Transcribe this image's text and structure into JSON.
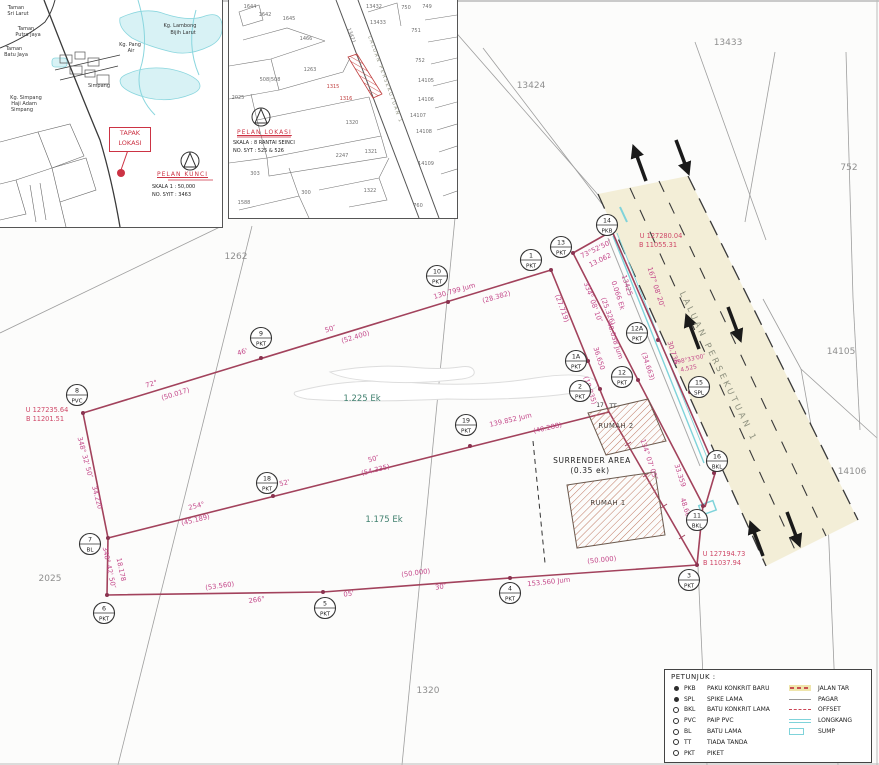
{
  "inset_key_map": {
    "title": "PELAN KUNCI",
    "scale": "SKALA 1 : 50,000",
    "sheet": "NO. SYIT : 3463",
    "marker_label": [
      "TAPAK",
      "LOKASI"
    ],
    "labels": [
      {
        "t": "Taman",
        "x": 16,
        "y": 9
      },
      {
        "t": "Sri Larut",
        "x": 18,
        "y": 15
      },
      {
        "t": "Taman",
        "x": 26,
        "y": 30
      },
      {
        "t": "Putra Jaya",
        "x": 28,
        "y": 36
      },
      {
        "t": "Taman",
        "x": 14,
        "y": 50
      },
      {
        "t": "Batu Jaya",
        "x": 16,
        "y": 56
      },
      {
        "t": "Kg. Lambong",
        "x": 180,
        "y": 27
      },
      {
        "t": "Bijih Larut",
        "x": 183,
        "y": 34
      },
      {
        "t": "Kg. Pang",
        "x": 130,
        "y": 46
      },
      {
        "t": "Air",
        "x": 131,
        "y": 52
      },
      {
        "t": "Simpang",
        "x": 99,
        "y": 87
      },
      {
        "t": "Kg. Simpang",
        "x": 26,
        "y": 99
      },
      {
        "t": "Haji Adam",
        "x": 24,
        "y": 105
      },
      {
        "t": "Simpang",
        "x": 22,
        "y": 111
      }
    ]
  },
  "inset_location_plan": {
    "title": "PELAN LOKASI",
    "scale": "SKALA : 8 RANTAI SEINCI",
    "sheet": "NO. SYT : 525 & 526",
    "road_label": "LALUAN PERSEKUTUAN 1",
    "labels": [
      {
        "t": "1644",
        "x": 21,
        "y": 8
      },
      {
        "t": "1642",
        "x": 36,
        "y": 16
      },
      {
        "t": "1645",
        "x": 60,
        "y": 20
      },
      {
        "t": "1466",
        "x": 77,
        "y": 40
      },
      {
        "t": "13432",
        "x": 145,
        "y": 8
      },
      {
        "t": "13433",
        "x": 149,
        "y": 24
      },
      {
        "t": "750",
        "x": 177,
        "y": 9
      },
      {
        "t": "749",
        "x": 198,
        "y": 8
      },
      {
        "t": "751",
        "x": 187,
        "y": 32
      },
      {
        "t": "1263",
        "x": 81,
        "y": 71
      },
      {
        "t": "508|508",
        "x": 41,
        "y": 81
      },
      {
        "t": "752",
        "x": 191,
        "y": 62
      },
      {
        "t": "2025",
        "x": 9,
        "y": 99
      },
      {
        "t": "1315",
        "x": 104,
        "y": 88,
        "c": "redl"
      },
      {
        "t": "1316",
        "x": 117,
        "y": 100,
        "c": "redl"
      },
      {
        "t": "14105",
        "x": 197,
        "y": 82
      },
      {
        "t": "14106",
        "x": 197,
        "y": 101
      },
      {
        "t": "14107",
        "x": 189,
        "y": 117
      },
      {
        "t": "14108",
        "x": 195,
        "y": 133
      },
      {
        "t": "1320",
        "x": 123,
        "y": 124
      },
      {
        "t": "1321",
        "x": 142,
        "y": 153
      },
      {
        "t": "2247",
        "x": 113,
        "y": 157
      },
      {
        "t": "14109",
        "x": 197,
        "y": 165
      },
      {
        "t": "303",
        "x": 26,
        "y": 175
      },
      {
        "t": "300",
        "x": 77,
        "y": 194
      },
      {
        "t": "1322",
        "x": 141,
        "y": 192
      },
      {
        "t": "1588",
        "x": 15,
        "y": 204
      },
      {
        "t": "760",
        "x": 189,
        "y": 207
      },
      {
        "t": "13421",
        "x": 121,
        "y": 36,
        "r": 70
      },
      {
        "t": "LALUAN PERSEKUTUAN 1",
        "x": 155,
        "y": 80,
        "r": 70,
        "c": "i2road"
      }
    ]
  },
  "main_plan": {
    "road_label": "LALUAN PERSEKUTUAN 1",
    "labels": [
      {
        "t": "72°",
        "x": 152,
        "y": 386,
        "r": -17
      },
      {
        "t": "(50.017)",
        "x": 176,
        "y": 396,
        "r": -17
      },
      {
        "t": "46'",
        "x": 243,
        "y": 354,
        "r": -17
      },
      {
        "t": "50″",
        "x": 331,
        "y": 331,
        "r": -17
      },
      {
        "t": "(52.400)",
        "x": 356,
        "y": 339,
        "r": -17
      },
      {
        "t": "130.799 Jum",
        "x": 455,
        "y": 293,
        "r": -16
      },
      {
        "t": "(28.382)",
        "x": 497,
        "y": 299,
        "r": -16
      },
      {
        "t": "254°",
        "x": 197,
        "y": 508,
        "r": -14
      },
      {
        "t": "(45.189)",
        "x": 196,
        "y": 522,
        "r": -14
      },
      {
        "t": "52'",
        "x": 285,
        "y": 485,
        "r": -14
      },
      {
        "t": "50″",
        "x": 374,
        "y": 461,
        "r": -14
      },
      {
        "t": "(54.335)",
        "x": 376,
        "y": 472,
        "r": -14
      },
      {
        "t": "139.852 Jum",
        "x": 511,
        "y": 422,
        "r": -13
      },
      {
        "t": "(40.288)",
        "x": 548,
        "y": 430,
        "r": -13
      },
      {
        "t": "(53.560)",
        "x": 220,
        "y": 588,
        "r": -8
      },
      {
        "t": "266°",
        "x": 257,
        "y": 602,
        "r": -8
      },
      {
        "t": "05'",
        "x": 349,
        "y": 596,
        "r": -8
      },
      {
        "t": "(50.000)",
        "x": 416,
        "y": 575,
        "r": -8
      },
      {
        "t": "30″",
        "x": 441,
        "y": 589,
        "r": -8
      },
      {
        "t": "153.560 Jum",
        "x": 549,
        "y": 584,
        "r": -6
      },
      {
        "t": "(50.000)",
        "x": 602,
        "y": 562,
        "r": -6
      },
      {
        "t": "348° 32' 50″",
        "x": 83,
        "y": 458,
        "r": 75
      },
      {
        "t": "34.220",
        "x": 95,
        "y": 498,
        "r": 75
      },
      {
        "t": "348° 42' 50″",
        "x": 107,
        "y": 568,
        "r": 78
      },
      {
        "t": "18.178",
        "x": 119,
        "y": 570,
        "r": 78
      },
      {
        "t": "73°52'50″",
        "x": 597,
        "y": 251,
        "r": -26
      },
      {
        "t": "13.062",
        "x": 601,
        "y": 262,
        "r": -26
      },
      {
        "t": "(27.719)",
        "x": 560,
        "y": 309,
        "r": 70
      },
      {
        "t": "334° 08' 10″",
        "x": 591,
        "y": 303,
        "r": 70
      },
      {
        "t": "(25.326)",
        "x": 606,
        "y": 312,
        "r": 70
      },
      {
        "t": "13425",
        "x": 625,
        "y": 286,
        "r": 72
      },
      {
        "t": "0.066 Ek",
        "x": 616,
        "y": 296,
        "r": 72
      },
      {
        "t": "40.038 Jum",
        "x": 613,
        "y": 341,
        "r": 72
      },
      {
        "t": "36.650",
        "x": 597,
        "y": 359,
        "r": 72
      },
      {
        "t": "(18.835)",
        "x": 588,
        "y": 391,
        "r": 72
      },
      {
        "t": "167° 08' 20″",
        "x": 654,
        "y": 288,
        "r": 72
      },
      {
        "t": "30.736",
        "x": 671,
        "y": 353,
        "r": 72
      },
      {
        "t": "(34.663)",
        "x": 646,
        "y": 367,
        "r": 72
      },
      {
        "t": "298°33'00″",
        "x": 690,
        "y": 361,
        "r": -12,
        "c": "m6"
      },
      {
        "t": "4.525",
        "x": 689,
        "y": 370,
        "r": -12,
        "c": "m6"
      },
      {
        "t": "134° 07' 05″",
        "x": 647,
        "y": 460,
        "r": 72
      },
      {
        "t": "33.359",
        "x": 678,
        "y": 476,
        "r": 72
      },
      {
        "t": "48.664",
        "x": 684,
        "y": 510,
        "r": 72
      },
      {
        "t": "U 127235.64",
        "x": 47,
        "y": 412,
        "c": "r"
      },
      {
        "t": "B 11201.51",
        "x": 45,
        "y": 421,
        "c": "r"
      },
      {
        "t": "U 127280.04",
        "x": 661,
        "y": 238,
        "c": "r"
      },
      {
        "t": "B 11055.31",
        "x": 658,
        "y": 247,
        "c": "r"
      },
      {
        "t": "U 127194.73",
        "x": 724,
        "y": 556,
        "c": "r"
      },
      {
        "t": "B 11037.94",
        "x": 722,
        "y": 565,
        "c": "r"
      },
      {
        "t": "1.225 Ek",
        "x": 362,
        "y": 401,
        "c": "t"
      },
      {
        "t": "1.175 Ek",
        "x": 384,
        "y": 522,
        "c": "t"
      },
      {
        "t": "13424",
        "x": 531,
        "y": 88,
        "c": "g"
      },
      {
        "t": "13433",
        "x": 728,
        "y": 45,
        "c": "g"
      },
      {
        "t": "752",
        "x": 849,
        "y": 170,
        "c": "g"
      },
      {
        "t": "14105",
        "x": 841,
        "y": 354,
        "c": "g"
      },
      {
        "t": "14106",
        "x": 852,
        "y": 474,
        "c": "g"
      },
      {
        "t": "1262",
        "x": 236,
        "y": 259,
        "c": "g"
      },
      {
        "t": "2025",
        "x": 50,
        "y": 581,
        "c": "g"
      },
      {
        "t": "1320",
        "x": 428,
        "y": 693,
        "c": "g"
      },
      {
        "t": "17",
        "x": 600,
        "y": 407,
        "c": "k"
      },
      {
        "t": "TT",
        "x": 613,
        "y": 408,
        "c": "k"
      },
      {
        "t": "RUMAH 2",
        "x": 616,
        "y": 428,
        "c": "b"
      },
      {
        "t": "RUMAH 1",
        "x": 608,
        "y": 505,
        "c": "b"
      },
      {
        "t": "SURRENDER AREA",
        "x": 592,
        "y": 463,
        "c": "s"
      },
      {
        "t": "(0.35 ek)",
        "x": 590,
        "y": 473,
        "c": "s"
      }
    ],
    "stations": [
      {
        "n": "10",
        "t": "PKT",
        "x": 437,
        "y": 276,
        "dx": 448,
        "dy": 302
      },
      {
        "n": "9",
        "t": "PKT",
        "x": 261,
        "y": 338,
        "dx": 261,
        "dy": 358
      },
      {
        "n": "8",
        "t": "PVC",
        "x": 77,
        "y": 395,
        "dx": 83,
        "dy": 413
      },
      {
        "n": "1",
        "t": "PKT",
        "x": 531,
        "y": 260,
        "dx": 551,
        "dy": 270
      },
      {
        "n": "13",
        "t": "PKT",
        "x": 561,
        "y": 247,
        "dx": 573,
        "dy": 253
      },
      {
        "n": "14",
        "t": "PKB",
        "x": 607,
        "y": 225,
        "dx": 612,
        "dy": 231
      },
      {
        "n": "1A",
        "t": "PKT",
        "x": 576,
        "y": 361,
        "dx": 588,
        "dy": 361
      },
      {
        "n": "2",
        "t": "PKT",
        "x": 580,
        "y": 391,
        "dx": 600,
        "dy": 389
      },
      {
        "n": "12A",
        "t": "PKT",
        "x": 637,
        "y": 333,
        "dx": 658,
        "dy": 340
      },
      {
        "n": "12",
        "t": "PKT",
        "x": 622,
        "y": 377,
        "dx": 638,
        "dy": 380
      },
      {
        "n": "15",
        "t": "SPL",
        "x": 699,
        "y": 387,
        "dx": 690,
        "dy": 392
      },
      {
        "n": "16",
        "t": "BKL",
        "x": 717,
        "y": 461,
        "dx": 714,
        "dy": 473
      },
      {
        "n": "11",
        "t": "BKL",
        "x": 697,
        "y": 520,
        "dx": 703,
        "dy": 506
      },
      {
        "n": "3",
        "t": "PKT",
        "x": 689,
        "y": 580,
        "dx": 697,
        "dy": 565
      },
      {
        "n": "4",
        "t": "PKT",
        "x": 510,
        "y": 593,
        "dx": 510,
        "dy": 578
      },
      {
        "n": "5",
        "t": "PKT",
        "x": 325,
        "y": 608,
        "dx": 323,
        "dy": 592
      },
      {
        "n": "6",
        "t": "PKT",
        "x": 104,
        "y": 613,
        "dx": 107,
        "dy": 595
      },
      {
        "n": "7",
        "t": "BL",
        "x": 90,
        "y": 544,
        "dx": 108,
        "dy": 538
      },
      {
        "n": "18",
        "t": "PKT",
        "x": 267,
        "y": 483,
        "dx": 273,
        "dy": 496
      },
      {
        "n": "19",
        "t": "PKT",
        "x": 466,
        "y": 425,
        "dx": 470,
        "dy": 446
      }
    ]
  },
  "legend": {
    "title": "PETUNJUK :",
    "point_items": [
      {
        "sym": "dot-filled",
        "code": "PKB",
        "label": "PAKU KONKRIT BARU"
      },
      {
        "sym": "dot-filled",
        "code": "SPL",
        "label": "SPIKE LAMA"
      },
      {
        "sym": "dot-open",
        "code": "BKL",
        "label": "BATU KONKRIT LAMA"
      },
      {
        "sym": "dot-open",
        "code": "PVC",
        "label": "PAIP PVC"
      },
      {
        "sym": "dot-open",
        "code": "BL",
        "label": "BATU LAMA"
      },
      {
        "sym": "dot-open",
        "code": "TT",
        "label": "TIADA TANDA"
      },
      {
        "sym": "dot-open",
        "code": "PKT",
        "label": "PIKET"
      }
    ],
    "line_items": [
      {
        "sym": "jalan-tar",
        "label": "JALAN TAR"
      },
      {
        "sym": "pagar",
        "label": "PAGAR"
      },
      {
        "sym": "offset",
        "label": "OFFSET"
      },
      {
        "sym": "longkang",
        "label": "LONGKANG"
      },
      {
        "sym": "sump",
        "label": "SUMP"
      }
    ]
  },
  "colors": {
    "survey_line": "#a2425c",
    "measurement_text": "#c4488a",
    "road_fill": "#f3eed7",
    "water": "#7fd3da",
    "red_accent": "#cc3344",
    "area_text": "#41806f"
  }
}
